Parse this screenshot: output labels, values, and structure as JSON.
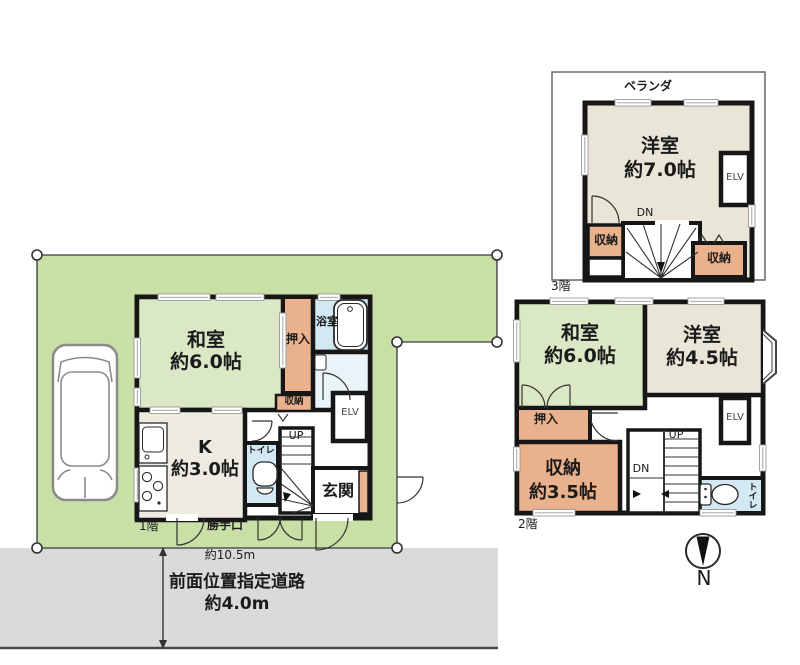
{
  "site": {
    "frontage_label": "約10.5m",
    "road_name": "前面位置指定道路",
    "road_width": "約4.0m",
    "compass_label": "N"
  },
  "floor1": {
    "name": "1階",
    "washitsu": "和室",
    "washitsu_size": "約6.0帖",
    "kitchen": "K",
    "kitchen_size": "約3.0帖",
    "oshiire": "押入",
    "bathroom": "浴室",
    "storage": "収納",
    "toilet": "トイレ",
    "entrance": "玄関",
    "back_door": "勝手口",
    "elevator": "ELV",
    "stairs_up": "UP"
  },
  "floor2": {
    "name": "2階",
    "washitsu": "和室",
    "washitsu_size": "約6.0帖",
    "youshitsu": "洋室",
    "youshitsu_size": "約4.5帖",
    "oshiire": "押入",
    "storage": "収納",
    "storage_size": "約3.5帖",
    "toilet": "トイレ",
    "elevator": "ELV",
    "stairs_up": "UP",
    "stairs_down": "DN"
  },
  "floor3": {
    "name": "3階",
    "veranda": "ベランダ",
    "youshitsu": "洋室",
    "youshitsu_size": "約7.0帖",
    "storage_left": "収納",
    "storage_right": "収納",
    "elevator": "ELV",
    "stairs_down": "DN"
  },
  "colors": {
    "lot_green": "#c8dfa5",
    "tatami_green": "#dbe8c6",
    "western_beige": "#e9e5d7",
    "closet_salmon": "#e9b28d",
    "wet_blue": "#d2e9f3",
    "road_gray": "#dadada",
    "wall_black": "#161616"
  }
}
